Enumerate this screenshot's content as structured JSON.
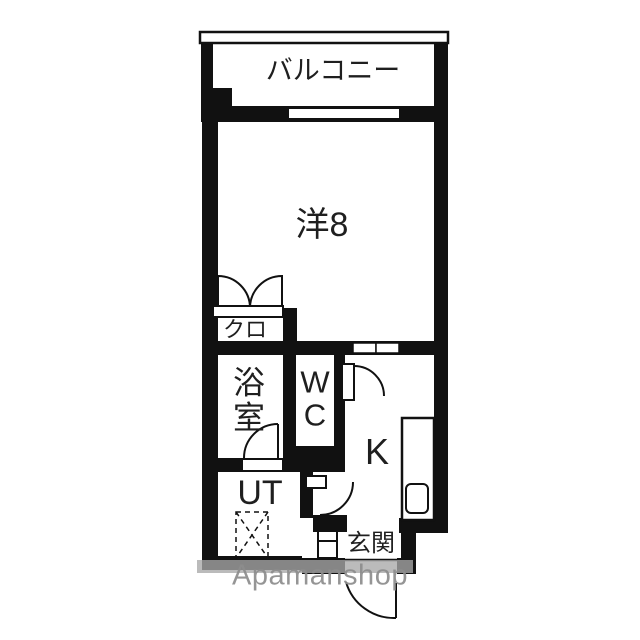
{
  "plan_title": "1K apartment floor plan",
  "rooms": {
    "balcony": {
      "label": "バルコニー"
    },
    "western_room": {
      "label": "洋8"
    },
    "closet": {
      "label": "クロ"
    },
    "bath": {
      "label": "浴室"
    },
    "toilet": {
      "label": "WC"
    },
    "kitchen": {
      "label": "K"
    },
    "utility": {
      "label": "UT"
    },
    "entrance": {
      "label": "玄関"
    }
  },
  "watermark": {
    "text": "Apamanshop"
  },
  "icons": {
    "closet_doors": "double-swing-closet-doors-icon",
    "bath_door": "bath-swing-door-icon",
    "toilet_door": "toilet-swing-door-icon",
    "hall_door": "hall-swing-door-icon",
    "entrance_door": "entrance-swing-door-icon",
    "washing_machine": "washing-machine-space-icon",
    "kitchen_sink": "kitchen-sink-icon",
    "kitchen_counter": "kitchen-counter-icon",
    "shoe_cabinet": "shoe-cabinet-icon",
    "window": "window-icon"
  },
  "colors": {
    "wall": "#111111",
    "line": "#111111",
    "text": "#1a1a1a",
    "background": "#ffffff",
    "watermark_band": "#a8a8a8",
    "watermark_text": "#8d8d8d"
  }
}
